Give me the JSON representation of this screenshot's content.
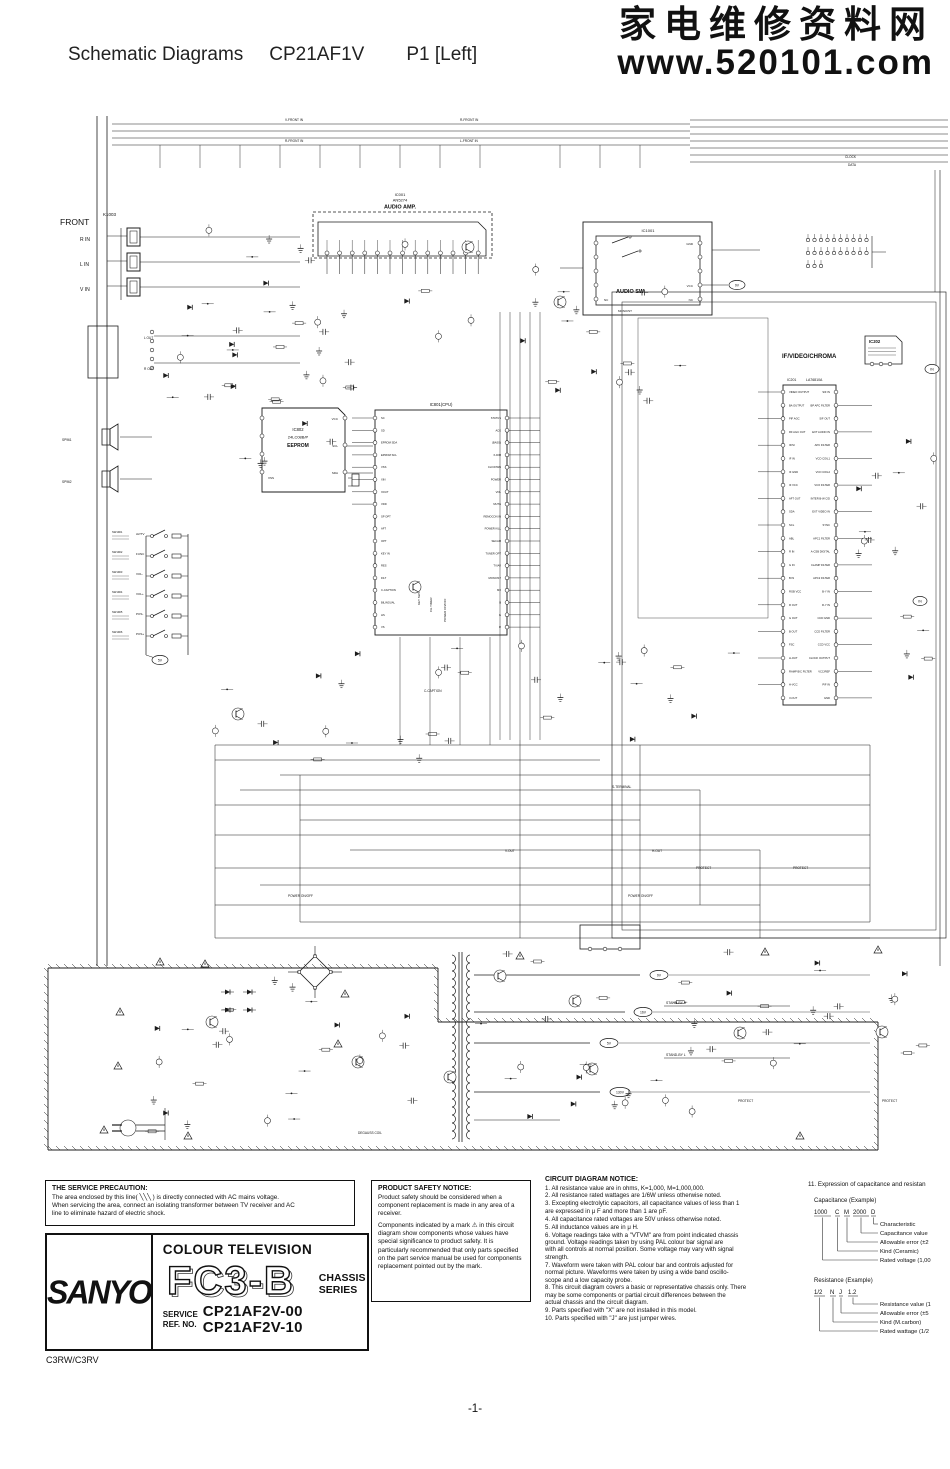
{
  "header": {
    "title_left": "Schematic Diagrams",
    "title_model": "CP21AF1V",
    "title_page": "P1  [Left]",
    "watermark_cn": "家电维修资料网",
    "watermark_url": "www.520101.com"
  },
  "schematic": {
    "front_label": "FRONT",
    "front_connector": "K1003",
    "jacks": [
      "R IN",
      "L IN",
      "V IN"
    ],
    "bus_labels": {
      "front_in": [
        "V-FRONT IN",
        "R-FRONT IN",
        "L-FRONT IN"
      ],
      "clock": "CLOCK",
      "data": "DATA"
    },
    "ic001": {
      "l1": "IC001",
      "l2": "AN5274",
      "l3": "AUDIO AMP."
    },
    "ic1001": {
      "l1": "IC1001",
      "func": "AUDIO SW",
      "gnd": "GND",
      "vcc": "VCC",
      "nc": "NC",
      "rail": "9V",
      "mono": "MONO/ST"
    },
    "ic202": {
      "l1": "IC202",
      "section": "IF/VIDEO/CHROMA"
    },
    "ic201": {
      "l1": "IC201",
      "l2": "LA76810A",
      "pins_left": [
        "VIDEO OUTPUT",
        "BA OUTPUT",
        "PIF AGC",
        "RF AGC OUT",
        "IF/SI",
        "IF IN",
        "IF GND",
        "IF VCC",
        "AFT OUT",
        "SDA",
        "SCL",
        "ABL",
        "R IN",
        "G IN",
        "B IN",
        "RGB VCC",
        "R OUT",
        "G OUT",
        "B OUT",
        "FSC",
        "H-OUT",
        "RAMP B/C FILTER",
        "H-VCC",
        "V-OUT"
      ],
      "pins_right": [
        "SIF IN",
        "BP APC FILTER",
        "SIF OUT",
        "EXT AUDIO IN",
        "APC FILTER",
        "VCO COIL1",
        "VCO COIL2",
        "VCO FILTER",
        "INTER B-W C/D",
        "EXT VIDEO IN",
        "SYNC",
        "APC1 FILTER",
        "A-CSB DIGITAL",
        "CLAMP FILTER",
        "APC2 FILTER",
        "B-Y IN",
        "R-Y IN",
        "CCD GND",
        "CCD FILTER",
        "CCD VCC",
        "CLOCK OUTPUT",
        "VCC/REF",
        "PIF IN",
        "GND"
      ]
    },
    "ic802": {
      "l1": "IC802",
      "l2": "24LC08B/P",
      "l3": "EEPROM",
      "vcc": "VCC",
      "scl": "SCL",
      "sda": "SDA",
      "vss": "VSS"
    },
    "ic801": {
      "l1": "IC801(CPU)",
      "pins_left": [
        "SC",
        "SD",
        "EPROM SDA",
        "EPROM SCL",
        "VSS",
        "XIN",
        "XOUT",
        "VDD",
        "SP OPT",
        "AFT",
        "OPT",
        "KEY IN",
        "RES",
        "FILT",
        "C-CAPTION",
        "BILINGUAL",
        "HS",
        "VS"
      ],
      "pins_right": [
        "STATUS",
        "ACK",
        "(BASS)",
        "X-DIM",
        "CH DOWN",
        "POWER",
        "VOL",
        "MUTE",
        "REMOCON IN",
        "POWER KILL",
        "SECAM",
        "TUNER OPT",
        "TV/AV",
        "MONO/ST",
        "MX",
        "B",
        "G",
        "R"
      ]
    },
    "switches": [
      {
        "id": "SW1901",
        "fn": "AV/TV"
      },
      {
        "id": "SW1902",
        "fn": "FUNC"
      },
      {
        "id": "SW1903",
        "fn": "VOL-"
      },
      {
        "id": "SW1904",
        "fn": "VOL+"
      },
      {
        "id": "SW1905",
        "fn": "POS-"
      },
      {
        "id": "SW1906",
        "fn": "POS+"
      }
    ],
    "speakers": [
      "SP961",
      "SP962"
    ],
    "headphone": [
      "L OUT",
      "R OUT"
    ],
    "rails": [
      "9V",
      "16V",
      "5V",
      "130V"
    ],
    "labels": {
      "standby_h": "STAND-BY H",
      "standby_l": "STAND-BY L",
      "protect": "PROTECT",
      "power_onoff": "POWER ON/OFF",
      "v_out": "V-OUT",
      "h_out": "H-OUT",
      "degauss": "DEGAUSS COIL",
      "key_sw": "KEY SW",
      "ch_timer": "CH.TIMER",
      "c_caption": "C-CAPTION",
      "s_terminal": "S-TERMINAL",
      "in_tag": "IN",
      "sw_rail": "5V"
    }
  },
  "notes": {
    "service_precaution": {
      "title": "THE SERVICE PRECAUTION:",
      "body": "The area enclosed by this line( ╲╲╲ ) is directly connected with AC mains voltage.\nWhen servicing the area, connect an isolating transformer between TV receiver and AC\nline to eliminate hazard of electric shock."
    },
    "product_safety": {
      "title": "PRODUCT SAFETY NOTICE:",
      "para1": "Product safety should be considered when a component replacement is made  in any area of a receiver.",
      "para2": "Components indicated by a mark ⚠ in this circuit diagram show components whose values have special significance to product safety. It is particularly recommended that only parts specified on the part service manual be used for components replacement pointed out by the mark."
    },
    "circuit_notice": {
      "title": "CIRCUIT DIAGRAM NOTICE:",
      "items": [
        "1. All resistance value are in ohms, K=1,000, M=1,000,000.",
        "2. All resistance rated wattages are 1/6W unless otherwise noted.",
        "3. Excepting electrolytic capacitors, all capacitance values of less than 1\n    are expressed in μ F and more than 1 are pF.",
        "4. All capacitance rated voltages are 50V unless otherwise noted.",
        "5. All inductance values are in μ H.",
        "6. Voltage readings take with a \"VTVM\" are from point indicated chassis\n    ground. Voltage readings taken by using PAL colour bar signal are\n    with all controls at normal position. Some voltage may vary with signal\n    strength.",
        "7. Waveform were taken with PAL colour bar and controls adjusted for\n    normal picture. Waveforms were taken by using a wide band oscillo-\n    scope and a low capacity probe.",
        "8. This circuit diagram covers a basic or representative chassis only. There\n    may be some components or partial circuit differences between the\n    actual chassis and the circuit diagram.",
        "9. Parts specified with \"X\" are not installed in this model.",
        "10. Parts specified with \"J\" are just jumper wires."
      ]
    }
  },
  "expression": {
    "title": "11. Expression of capacitance and resistan",
    "cap": {
      "heading": "Capacitance (Example)",
      "tokens": [
        "1000",
        "C",
        "M",
        "2000",
        "D"
      ],
      "callouts": [
        "Characteristic",
        "Capacitance value",
        "Allowable error (±2",
        "Kind (Ceramic)",
        "Rated voltage (1,00"
      ]
    },
    "res": {
      "heading": "Resistance (Example)",
      "tokens": [
        "1/2",
        "N",
        "J",
        "1.2"
      ],
      "callouts": [
        "Resistance value (1",
        "Allowable error (±5",
        "Kind (M.carbon)",
        "Rated wattage (1/2"
      ]
    }
  },
  "brand": {
    "logo": "SANYO",
    "product": "COLOUR TELEVISION",
    "chassis_name": "FC3-B",
    "chassis_l1": "CHASSIS",
    "chassis_l2": "SERIES",
    "service_l1": "SERVICE",
    "service_l2": "REF. NO.",
    "model1": "CP21AF2V-00",
    "model2": "CP21AF2V-10",
    "chassis_code": "C3RW/C3RV"
  },
  "footer": {
    "page": "-1-"
  }
}
